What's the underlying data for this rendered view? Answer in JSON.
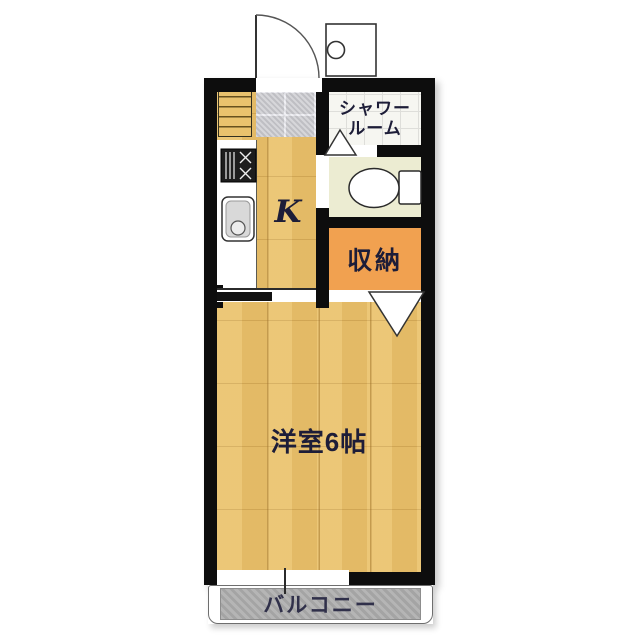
{
  "plan": {
    "rooms": {
      "kitchen": {
        "label": "K"
      },
      "shower_room": {
        "label_line1": "シャワー",
        "label_line2": "ルーム"
      },
      "storage": {
        "label": "収納"
      },
      "western_room": {
        "label": "洋室6帖"
      },
      "balcony": {
        "label": "バルコニー"
      }
    }
  },
  "colors": {
    "wall": "#0d0d0d",
    "floor-wood": "#eac26d",
    "tile": "#c9c9cd",
    "shower-floor": "#f6f6f1",
    "toilet-floor": "#ececd2",
    "storage": "#f1a150",
    "balcony": "#aeaeae",
    "label": "#1d1d38"
  }
}
